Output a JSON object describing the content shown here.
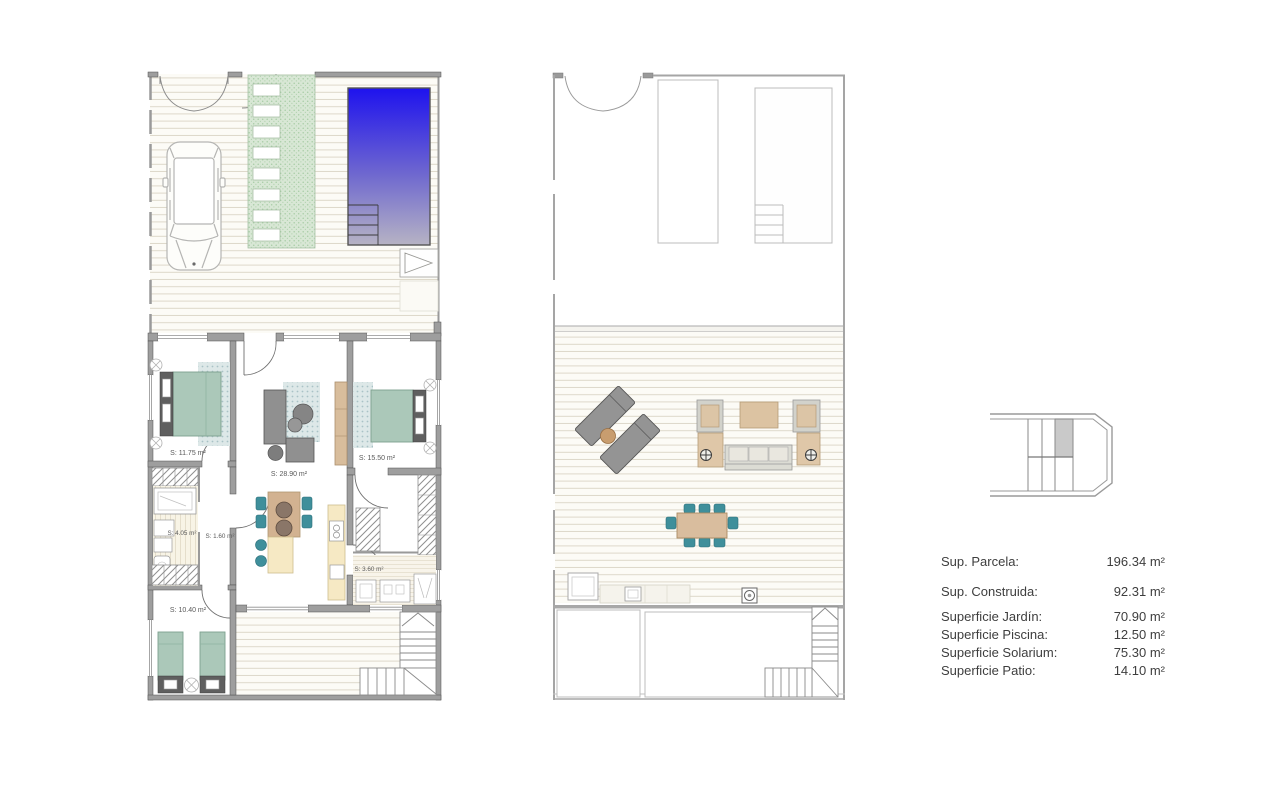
{
  "plans": {
    "ground_floor": {
      "room_labels": {
        "bedroom_1": "S: 11.75 m²",
        "living_kitchen": "S: 28.90 m²",
        "bedroom_2": "S: 15.50 m²",
        "bathroom_1": "S: 4.05 m²",
        "hall": "S: 1.60 m²",
        "bathroom_2": "S: 3.60 m²",
        "bedroom_3": "S: 10.40 m²"
      }
    },
    "solarium": {
      "room_labels": {}
    }
  },
  "summary": {
    "rows": [
      {
        "label": "Sup. Parcela:",
        "value": "196.34 m²"
      },
      {
        "label": "Sup. Construida:",
        "value": "92.31 m²"
      },
      {
        "label": "Superficie Jardín:",
        "value": "70.90 m²"
      },
      {
        "label": "Superficie Piscina:",
        "value": "12.50 m²"
      },
      {
        "label": "Superficie Solarium:",
        "value": "75.30 m²"
      },
      {
        "label": "Superficie Patio:",
        "value": "14.10 m²"
      }
    ]
  },
  "colors": {
    "pool_top": "#1e12ee",
    "pool_bottom": "#b6b3c4",
    "lawn_green": "#d8e7d5",
    "furniture_teal": "#3f8f9b",
    "bed_green": "#abc8b9",
    "wood_tan": "#d2b291",
    "kitchen_cream": "#f6e9c4",
    "wall_gray": "#9e9e9e",
    "text_gray": "#3e3e3e"
  }
}
